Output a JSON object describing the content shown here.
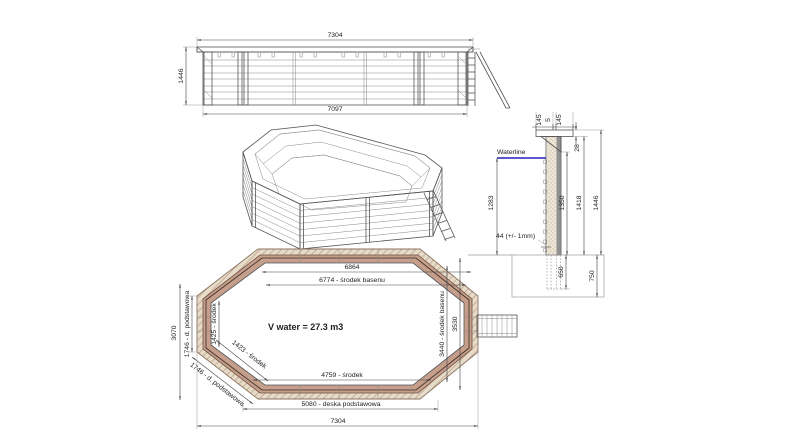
{
  "drawing": {
    "elevation": {
      "dim_top": "7304",
      "dim_bottom": "7097",
      "dim_height": "1446"
    },
    "section": {
      "waterline": "Waterline",
      "cap_left": "145",
      "cap_gap": "5",
      "cap_right": "145",
      "cap_drop": "28",
      "water_depth": "1283",
      "wall_height": "1350",
      "height_upper": "1418",
      "height_total": "1446",
      "plank_tolerance": "44 (+/- 1mm)",
      "embed_depth": "650",
      "foundation_depth": "750"
    },
    "plan": {
      "inner_width": "6864",
      "center_width": "6774 - środek basenu",
      "left_span": "3070",
      "left_base": "1746 - d. podstawowa",
      "left_center": "1425 - środek",
      "diag_center": "1423 - środek",
      "diag_base": "1746 - d. podstawowa",
      "center_height": "3440 - środek basenu",
      "outer_height": "3530",
      "volume": "V water = 27.3 m3",
      "bottom_center": "4759 - środek",
      "bottom_base": "5080 - deska podstawowa",
      "bottom_width": "7304"
    },
    "colors": {
      "waterline": "#2222bb",
      "deck_fill": "#e7dbc9",
      "deck_hatch": "#b59a7d",
      "wall_band": "#c59e8c",
      "line": "#444444"
    }
  }
}
